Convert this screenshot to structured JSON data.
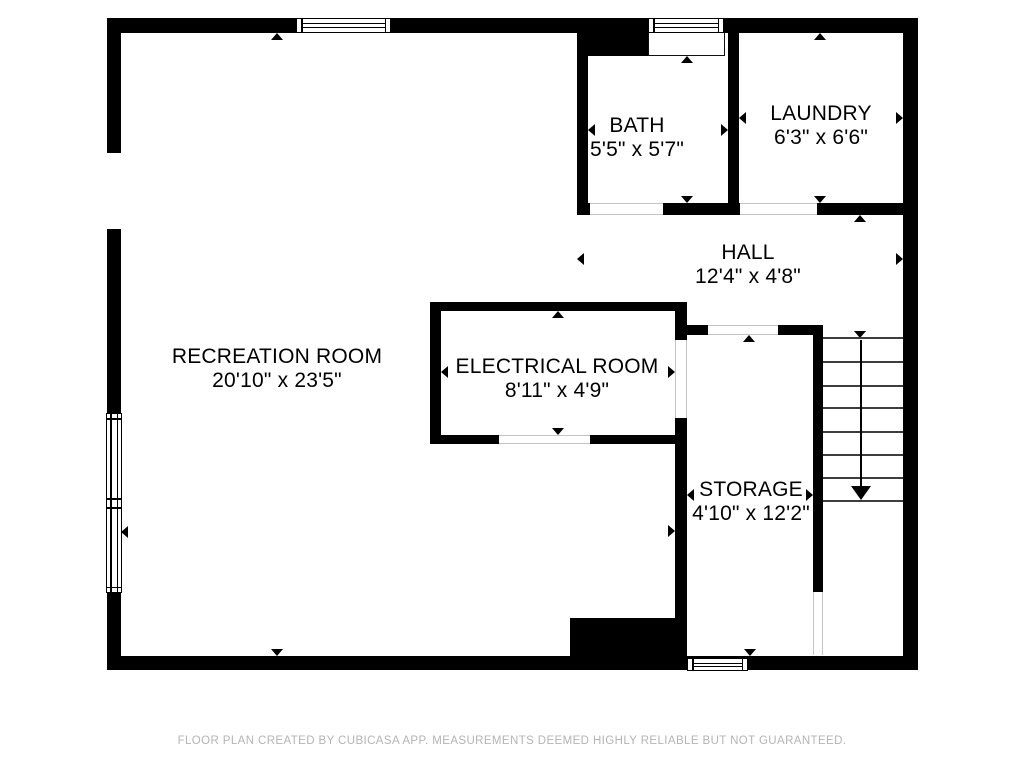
{
  "footer": {
    "text": "FLOOR PLAN CREATED BY CUBICASA APP. MEASUREMENTS DEEMED HIGHLY RELIABLE BUT NOT GUARANTEED."
  },
  "colors": {
    "wall": "#000000",
    "background": "#ffffff",
    "footer_text": "#b4b4b4",
    "stair_tread": "#3d3d3d",
    "door_edge": "#c4c4c4"
  },
  "plan": {
    "rooms": [
      {
        "id": "recreation-room",
        "name": "RECREATION ROOM",
        "dims": "20'10\" x 23'5\"",
        "cx": 277,
        "cy": 357
      },
      {
        "id": "bath",
        "name": "BATH",
        "dims": "5'5\" x 5'7\"",
        "cx": 637,
        "cy": 126
      },
      {
        "id": "laundry",
        "name": "LAUNDRY",
        "dims": "6'3\" x 6'6\"",
        "cx": 821,
        "cy": 114
      },
      {
        "id": "hall",
        "name": "HALL",
        "dims": "12'4\" x 4'8\"",
        "cx": 748,
        "cy": 253
      },
      {
        "id": "electrical-room",
        "name": "ELECTRICAL ROOM",
        "dims": "8'11\" x 4'9\"",
        "cx": 557,
        "cy": 367
      },
      {
        "id": "storage",
        "name": "STORAGE",
        "dims": "4'10\" x 12'2\"",
        "cx": 751,
        "cy": 490
      }
    ],
    "walls": [
      [
        107,
        18,
        811,
        15
      ],
      [
        107,
        18,
        14,
        652
      ],
      [
        903,
        18,
        15,
        652
      ],
      [
        107,
        656,
        811,
        14
      ],
      [
        577,
        33,
        11,
        182
      ],
      [
        588,
        33,
        60,
        23
      ],
      [
        728,
        33,
        11,
        182
      ],
      [
        577,
        203,
        13,
        12
      ],
      [
        663,
        203,
        77,
        12
      ],
      [
        817,
        203,
        98,
        12
      ],
      [
        430,
        302,
        255,
        9
      ],
      [
        430,
        302,
        11,
        142
      ],
      [
        430,
        435,
        255,
        9
      ],
      [
        675,
        302,
        12,
        40
      ],
      [
        675,
        418,
        12,
        200
      ],
      [
        687,
        325,
        21,
        10
      ],
      [
        778,
        325,
        35,
        10
      ],
      [
        813,
        325,
        10,
        267
      ],
      [
        570,
        618,
        117,
        40
      ]
    ],
    "windows": [
      [
        296,
        18,
        95,
        15,
        "h"
      ],
      [
        648,
        18,
        76,
        15,
        "h"
      ],
      [
        106,
        413,
        16,
        180,
        "v"
      ],
      [
        687,
        658,
        61,
        13,
        "h"
      ]
    ],
    "bay_recess": [
      648,
      33,
      77,
      23
    ],
    "wall_opening": [
      107,
      153,
      14,
      76
    ],
    "doors": [
      [
        590,
        203,
        73,
        12,
        "h"
      ],
      [
        740,
        203,
        77,
        12,
        "h"
      ],
      [
        708,
        325,
        70,
        10,
        "h"
      ],
      [
        499,
        435,
        91,
        9,
        "h"
      ],
      [
        675,
        340,
        12,
        78,
        "v"
      ],
      [
        813,
        592,
        10,
        63,
        "v"
      ]
    ],
    "measure_arrows": [
      [
        277,
        33,
        "up"
      ],
      [
        277,
        656,
        "down"
      ],
      [
        121,
        532,
        "left"
      ],
      [
        675,
        531,
        "right"
      ],
      [
        687,
        56,
        "up"
      ],
      [
        687,
        203,
        "down"
      ],
      [
        588,
        130,
        "left"
      ],
      [
        728,
        130,
        "right"
      ],
      [
        820,
        33,
        "up"
      ],
      [
        820,
        203,
        "down"
      ],
      [
        739,
        118,
        "left"
      ],
      [
        903,
        118,
        "right"
      ],
      [
        860,
        215,
        "up"
      ],
      [
        860,
        338,
        "down"
      ],
      [
        577,
        259,
        "left"
      ],
      [
        903,
        259,
        "right"
      ],
      [
        558,
        311,
        "up"
      ],
      [
        558,
        435,
        "down"
      ],
      [
        441,
        372,
        "left"
      ],
      [
        675,
        372,
        "right"
      ],
      [
        749,
        335,
        "up"
      ],
      [
        750,
        656,
        "down"
      ],
      [
        687,
        495,
        "left"
      ],
      [
        813,
        495,
        "right"
      ]
    ],
    "stairs": {
      "x1": 823,
      "x2": 903,
      "treads_y": [
        338,
        362,
        386,
        408,
        432,
        455,
        478,
        501
      ],
      "line_x": 861,
      "line_y1": 340,
      "line_y2": 488,
      "small_tip_y": 336,
      "arrow_tip_y": 500
    }
  }
}
